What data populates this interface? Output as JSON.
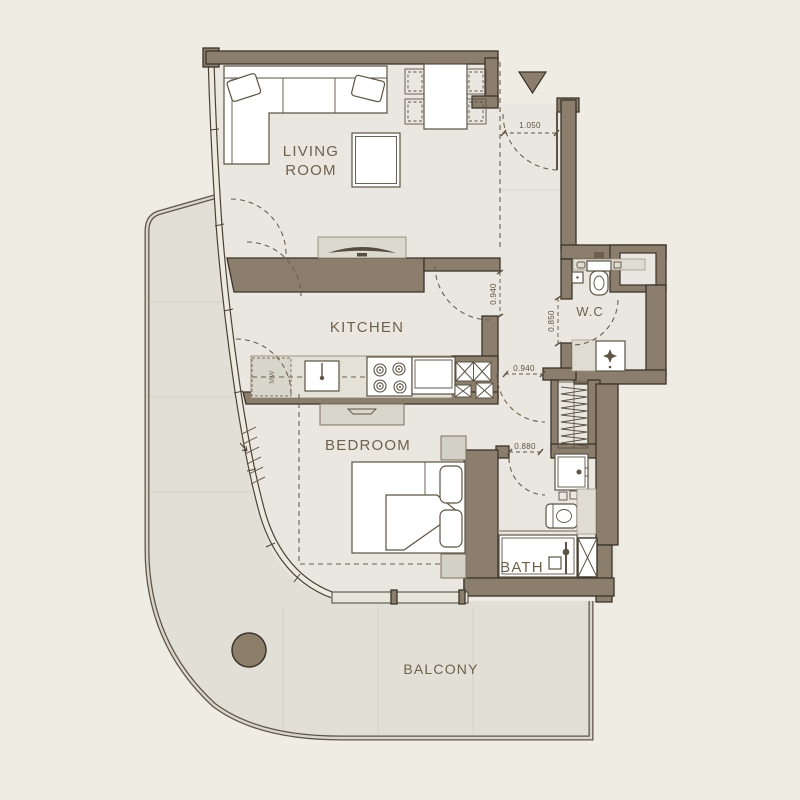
{
  "plan": {
    "rooms": {
      "living_line1": "LIVING",
      "living_line2": "ROOM",
      "kitchen": "KITCHEN",
      "bedroom": "BEDROOM",
      "wc": "W.C",
      "bath": "BATH",
      "balcony": "BALCONY"
    },
    "dimensions": {
      "entry_door": "1.050",
      "kitchen_door": "0.940",
      "wc_door": "0.850",
      "bedroom_door": "0.940",
      "bath_door": "0.880"
    },
    "appliances": {
      "microwave": "MW"
    },
    "colors": {
      "bg": "#EFECE4",
      "wall": "#8B7E6C",
      "wallStroke": "#3A342B",
      "floor": "#EAE7E1",
      "balcony": "#E2DFD6",
      "line": "#5C5344",
      "dash": "#6B5F4E",
      "label": "#6E614C",
      "dim": "#5F5442",
      "counter": "#E4E1D7",
      "grayfill": "#DFDCD2",
      "console": "#DCD9CE",
      "column": "#8C7E68",
      "windowwall": "#E8E5DB"
    }
  }
}
